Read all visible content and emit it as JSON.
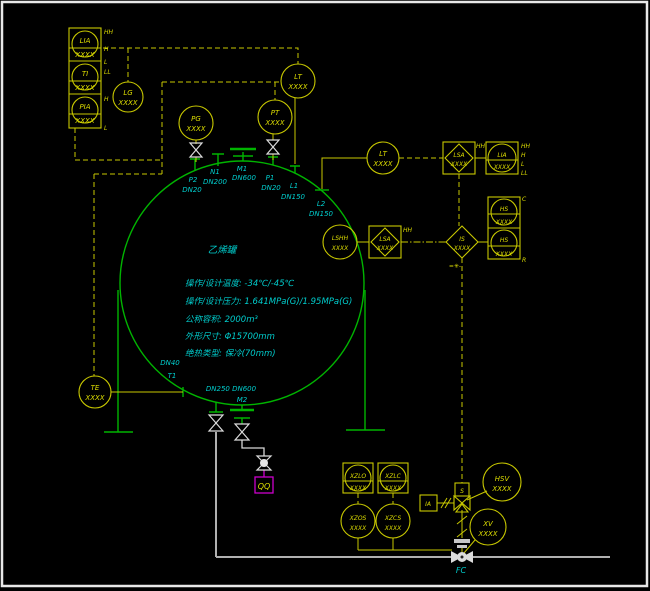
{
  "colors": {
    "background": "#000000",
    "tank_green": "#00B400",
    "instrument_yellow": "#DCDC00",
    "label_cyan": "#00CCCC",
    "pipe_gray": "#B0B0B0",
    "valve_white": "#DCDCDC",
    "drain_magenta": "#CC00CC"
  },
  "tank": {
    "name": "乙烯罐",
    "specs": [
      "操作/设计温度: -34℃/-45℃",
      "操作/设计压力: 1.641MPa(G)/1.95MPa(G)",
      "公称容积: 2000m³",
      "外形尺寸: Φ15700mm",
      "绝热类型: 保冷(70mm)"
    ]
  },
  "nozzles": {
    "p2": {
      "tag": "P2",
      "dn": "DN20"
    },
    "n1": {
      "tag": "N1",
      "dn": "DN200"
    },
    "m1": {
      "tag": "M1",
      "dn": "DN600"
    },
    "p1": {
      "tag": "P1",
      "dn": "DN20"
    },
    "l1": {
      "tag": "L1",
      "dn": "DN150"
    },
    "l2": {
      "tag": "L2",
      "dn": "DN150"
    },
    "t1": {
      "tag": "T1",
      "dn": "DN40"
    },
    "m2": {
      "tag": "M2",
      "dn": "DN250 DN600"
    }
  },
  "instruments": {
    "lia_tl": {
      "tag": "LIA",
      "num": "XXXX",
      "m1": "HH",
      "m2": "H",
      "m3": "L",
      "m4": "LL"
    },
    "ti_tl": {
      "tag": "TI",
      "num": "XXXX"
    },
    "pia_tl": {
      "tag": "PIA",
      "num": "XXXX",
      "m1": "H",
      "m2": "L"
    },
    "lg": {
      "tag": "LG",
      "num": "XXXX"
    },
    "pg": {
      "tag": "PG",
      "num": "XXXX"
    },
    "pt": {
      "tag": "PT",
      "num": "XXXX"
    },
    "lt_top": {
      "tag": "LT",
      "num": "XXXX"
    },
    "lt_right": {
      "tag": "LT",
      "num": "XXXX"
    },
    "lsa_1": {
      "tag": "LSA",
      "num": "XXXX",
      "m1": "HH"
    },
    "lia_right": {
      "tag": "LIA",
      "num": "XXXX",
      "m1": "HH",
      "m2": "H",
      "m3": "L",
      "m4": "LL"
    },
    "lshh": {
      "tag": "LSHH",
      "num": "XXXX"
    },
    "lsa_2": {
      "tag": "LSA",
      "num": "XXXX",
      "m1": "HH"
    },
    "is": {
      "tag": "IS",
      "num": "XXXX"
    },
    "hs_c": {
      "tag": "HS",
      "num": "XXXX",
      "m1": "C"
    },
    "hs_r": {
      "tag": "HS",
      "num": "XXXX",
      "m1": "R"
    },
    "te": {
      "tag": "TE",
      "num": "XXXX"
    },
    "xzlo": {
      "tag": "XZLO",
      "num": "XXXX"
    },
    "xzlc": {
      "tag": "XZLC",
      "num": "XXXX"
    },
    "xzos": {
      "tag": "XZOS",
      "num": "XXXX"
    },
    "xzcs": {
      "tag": "XZCS",
      "num": "XXXX"
    },
    "hsv": {
      "tag": "HSV",
      "num": "XXXX"
    },
    "xv": {
      "tag": "XV",
      "num": "XXXX"
    }
  },
  "valve_labels": {
    "solenoid": "S",
    "air_supply": "IA",
    "fail_mode": "FC",
    "drain_box": "QQ",
    "interlock_note": "=✳-"
  }
}
